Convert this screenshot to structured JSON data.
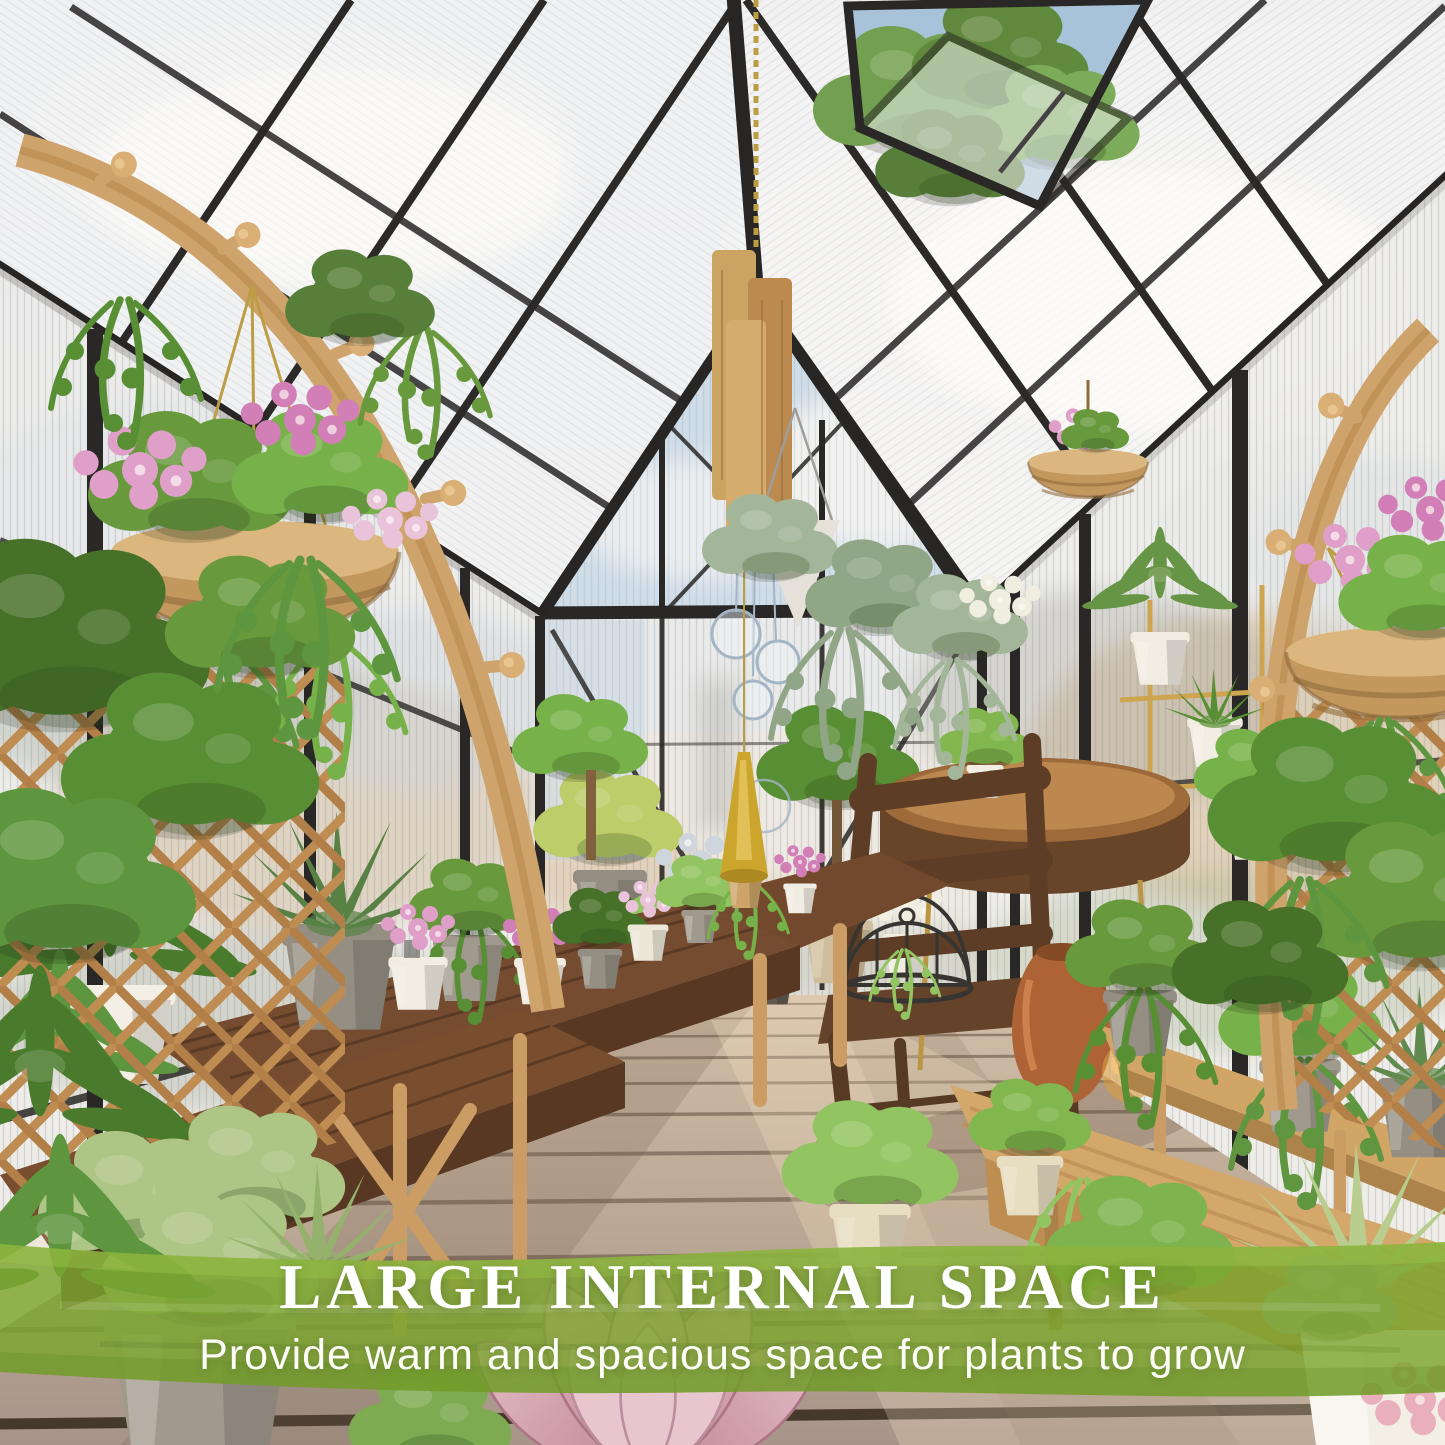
{
  "banner": {
    "title": "LARGE INTERNAL SPACE",
    "subtitle": "Provide warm and spacious space for plants to grow",
    "band_color": "#7ca52e",
    "title_color": "#ffffff",
    "subtitle_color": "#fbfdf6"
  },
  "scene": {
    "type": "greenhouse-interior-marketing-photo",
    "elements": [
      "black aluminum frame gable greenhouse",
      "translucent polycarbonate roof and wall panels",
      "open roof vent window with tree visible outside",
      "hanging wood-block ornament with glass bulbs and brass bell",
      "wooden arch trellis with pegs and hanging wicker flower baskets (left and right)",
      "lattice trellis panels with climbing pothos",
      "dark walnut tiered plant benches with potted plants",
      "light oak bench and wall shelf with trailing plants",
      "rustic wooden chair with wire birdcage",
      "round wooden side table",
      "terracotta urn and amber glass jar",
      "wood plank deck floor with sunlight and shadows",
      "pink petunias, agave, ferns, succulents, echeveria rosette"
    ],
    "palette": {
      "frame_black": "#1d1d1f",
      "panel_tint": "#eef1f5",
      "sky_blue": "#aac6e4",
      "light_oak": "#cda06a",
      "dark_walnut": "#6a4026",
      "deck": "#b7a595",
      "foliage_green": "#5f9638",
      "flower_pink": "#dd9ccc",
      "terracotta": "#b0613b"
    }
  }
}
